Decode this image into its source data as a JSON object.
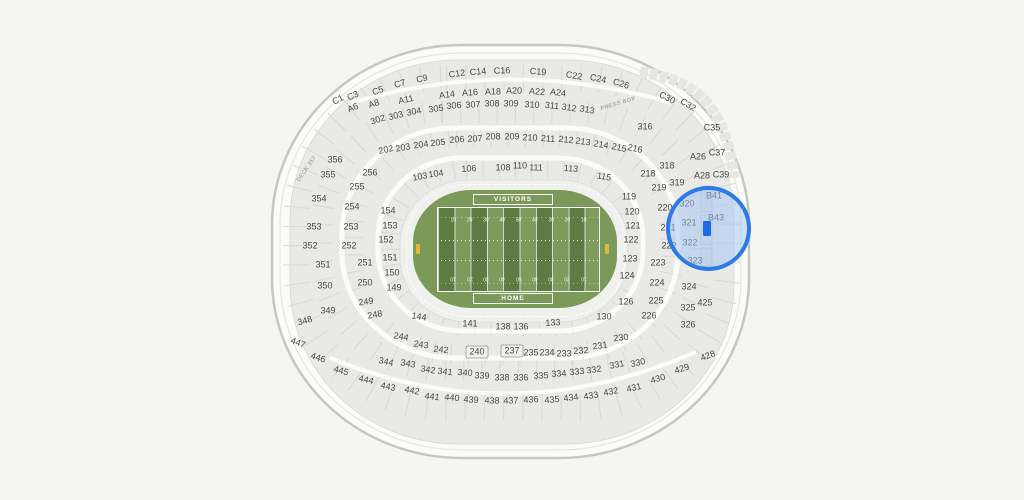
{
  "canvas": {
    "width": 1024,
    "height": 500,
    "background": "#f5f5f2"
  },
  "stadium": {
    "press_box_label": "PRESS BOX",
    "deck_label": "DECK 357",
    "wall_fill": "#fbfbf9",
    "wall_stroke": "#c6c6c3",
    "bowl_fill": "#e9e9e7"
  },
  "field": {
    "visitors_label": "VISITORS",
    "home_label": "HOME",
    "yard_numbers": [
      "10",
      "20",
      "30",
      "40",
      "50",
      "40",
      "30",
      "20",
      "10"
    ],
    "grass_outer": "#7b9a5a",
    "stripe_dark": "#5d7c44",
    "stripe_light": "#7e9b5e",
    "goalpost_color": "#ddb93c"
  },
  "highlight": {
    "circle_border": "#2e79e8",
    "circle_fill": "rgba(160,198,244,0.5)",
    "marker_color": "#1b69e5",
    "sections_in_view": [
      "320",
      "321",
      "322",
      "323",
      "B41",
      "B43"
    ]
  },
  "sections": [
    {
      "id": "C1",
      "x": 338,
      "y": 100,
      "r": -28
    },
    {
      "id": "C3",
      "x": 353,
      "y": 96,
      "r": -24
    },
    {
      "id": "C5",
      "x": 378,
      "y": 91,
      "r": -20
    },
    {
      "id": "C7",
      "x": 400,
      "y": 84,
      "r": -16
    },
    {
      "id": "C9",
      "x": 422,
      "y": 79,
      "r": -13
    },
    {
      "id": "C12",
      "x": 457,
      "y": 74,
      "r": -8
    },
    {
      "id": "C14",
      "x": 478,
      "y": 72,
      "r": -5
    },
    {
      "id": "C16",
      "x": 502,
      "y": 71,
      "r": -2
    },
    {
      "id": "C19",
      "x": 538,
      "y": 72,
      "r": 4
    },
    {
      "id": "C22",
      "x": 574,
      "y": 76,
      "r": 9
    },
    {
      "id": "C24",
      "x": 598,
      "y": 79,
      "r": 13
    },
    {
      "id": "C26",
      "x": 621,
      "y": 84,
      "r": 17
    },
    {
      "id": "C30",
      "x": 667,
      "y": 98,
      "r": 28
    },
    {
      "id": "C32",
      "x": 688,
      "y": 105,
      "r": 32
    },
    {
      "id": "C35",
      "x": 712,
      "y": 128,
      "r": 0
    },
    {
      "id": "C37",
      "x": 717,
      "y": 153,
      "r": 0
    },
    {
      "id": "C39",
      "x": 721,
      "y": 175,
      "r": 0
    },
    {
      "id": "A6",
      "x": 353,
      "y": 108,
      "r": -22
    },
    {
      "id": "A8",
      "x": 374,
      "y": 104,
      "r": -18
    },
    {
      "id": "A11",
      "x": 406,
      "y": 100,
      "r": -12
    },
    {
      "id": "A14",
      "x": 447,
      "y": 95,
      "r": -7
    },
    {
      "id": "A16",
      "x": 470,
      "y": 93,
      "r": -4
    },
    {
      "id": "A18",
      "x": 493,
      "y": 92,
      "r": -1
    },
    {
      "id": "A20",
      "x": 514,
      "y": 91,
      "r": 1
    },
    {
      "id": "A22",
      "x": 537,
      "y": 92,
      "r": 4
    },
    {
      "id": "A24",
      "x": 558,
      "y": 93,
      "r": 7
    },
    {
      "id": "A26",
      "x": 698,
      "y": 157,
      "r": 0
    },
    {
      "id": "A28",
      "x": 702,
      "y": 176,
      "r": 0
    },
    {
      "id": "302",
      "x": 378,
      "y": 120,
      "r": -18
    },
    {
      "id": "303",
      "x": 396,
      "y": 116,
      "r": -14
    },
    {
      "id": "304",
      "x": 414,
      "y": 112,
      "r": -11
    },
    {
      "id": "305",
      "x": 436,
      "y": 109,
      "r": -8
    },
    {
      "id": "306",
      "x": 454,
      "y": 106,
      "r": -5
    },
    {
      "id": "307",
      "x": 473,
      "y": 105,
      "r": -3
    },
    {
      "id": "308",
      "x": 492,
      "y": 104,
      "r": 0
    },
    {
      "id": "309",
      "x": 511,
      "y": 104,
      "r": 0
    },
    {
      "id": "310",
      "x": 532,
      "y": 105,
      "r": 3
    },
    {
      "id": "311",
      "x": 552,
      "y": 106,
      "r": 6
    },
    {
      "id": "312",
      "x": 569,
      "y": 108,
      "r": 8
    },
    {
      "id": "313",
      "x": 587,
      "y": 110,
      "r": 10
    },
    {
      "id": "316",
      "x": 645,
      "y": 127,
      "r": 0
    },
    {
      "id": "202",
      "x": 386,
      "y": 150,
      "r": -12
    },
    {
      "id": "203",
      "x": 403,
      "y": 148,
      "r": -10
    },
    {
      "id": "204",
      "x": 421,
      "y": 145,
      "r": -8
    },
    {
      "id": "205",
      "x": 438,
      "y": 143,
      "r": -6
    },
    {
      "id": "206",
      "x": 457,
      "y": 140,
      "r": -4
    },
    {
      "id": "207",
      "x": 475,
      "y": 139,
      "r": -2
    },
    {
      "id": "208",
      "x": 493,
      "y": 137,
      "r": 0
    },
    {
      "id": "209",
      "x": 512,
      "y": 137,
      "r": 0
    },
    {
      "id": "210",
      "x": 530,
      "y": 138,
      "r": 2
    },
    {
      "id": "211",
      "x": 548,
      "y": 139,
      "r": 4
    },
    {
      "id": "212",
      "x": 566,
      "y": 140,
      "r": 6
    },
    {
      "id": "213",
      "x": 583,
      "y": 142,
      "r": 8
    },
    {
      "id": "214",
      "x": 601,
      "y": 145,
      "r": 10
    },
    {
      "id": "215",
      "x": 619,
      "y": 148,
      "r": 12
    },
    {
      "id": "216",
      "x": 635,
      "y": 149,
      "r": 12
    },
    {
      "id": "103",
      "x": 420,
      "y": 177,
      "r": -10
    },
    {
      "id": "104",
      "x": 436,
      "y": 174,
      "r": -8
    },
    {
      "id": "106",
      "x": 469,
      "y": 169,
      "r": -4
    },
    {
      "id": "108",
      "x": 503,
      "y": 168,
      "r": 0
    },
    {
      "id": "110",
      "x": 520,
      "y": 166,
      "r": 0
    },
    {
      "id": "111",
      "x": 536,
      "y": 168,
      "r": 2
    },
    {
      "id": "113",
      "x": 571,
      "y": 169,
      "r": 5
    },
    {
      "id": "115",
      "x": 604,
      "y": 177,
      "r": 10
    },
    {
      "id": "356",
      "x": 335,
      "y": 160,
      "r": 0
    },
    {
      "id": "355",
      "x": 328,
      "y": 175,
      "r": 0
    },
    {
      "id": "354",
      "x": 319,
      "y": 199,
      "r": 0
    },
    {
      "id": "353",
      "x": 314,
      "y": 227,
      "r": 0
    },
    {
      "id": "352",
      "x": 310,
      "y": 246,
      "r": 0
    },
    {
      "id": "351",
      "x": 323,
      "y": 265,
      "r": 0
    },
    {
      "id": "350",
      "x": 325,
      "y": 286,
      "r": 0
    },
    {
      "id": "349",
      "x": 328,
      "y": 311,
      "r": 0
    },
    {
      "id": "348",
      "x": 305,
      "y": 321,
      "r": -15
    },
    {
      "id": "256",
      "x": 370,
      "y": 173,
      "r": 0
    },
    {
      "id": "255",
      "x": 357,
      "y": 187,
      "r": 0
    },
    {
      "id": "254",
      "x": 352,
      "y": 207,
      "r": 0
    },
    {
      "id": "253",
      "x": 351,
      "y": 227,
      "r": 0
    },
    {
      "id": "252",
      "x": 349,
      "y": 246,
      "r": 0
    },
    {
      "id": "251",
      "x": 365,
      "y": 263,
      "r": 0
    },
    {
      "id": "250",
      "x": 365,
      "y": 283,
      "r": 0
    },
    {
      "id": "249",
      "x": 366,
      "y": 302,
      "r": -8
    },
    {
      "id": "248",
      "x": 375,
      "y": 315,
      "r": -10
    },
    {
      "id": "154",
      "x": 388,
      "y": 211,
      "r": 0
    },
    {
      "id": "153",
      "x": 390,
      "y": 226,
      "r": 0
    },
    {
      "id": "152",
      "x": 386,
      "y": 240,
      "r": 0
    },
    {
      "id": "151",
      "x": 390,
      "y": 258,
      "r": 0
    },
    {
      "id": "150",
      "x": 392,
      "y": 273,
      "r": 0
    },
    {
      "id": "149",
      "x": 394,
      "y": 288,
      "r": 0
    },
    {
      "id": "119",
      "x": 629,
      "y": 197,
      "r": 0
    },
    {
      "id": "120",
      "x": 632,
      "y": 212,
      "r": 0
    },
    {
      "id": "121",
      "x": 633,
      "y": 226,
      "r": 0
    },
    {
      "id": "122",
      "x": 631,
      "y": 240,
      "r": 0
    },
    {
      "id": "123",
      "x": 630,
      "y": 259,
      "r": 0
    },
    {
      "id": "124",
      "x": 627,
      "y": 276,
      "r": 0
    },
    {
      "id": "126",
      "x": 626,
      "y": 302,
      "r": 0
    },
    {
      "id": "130",
      "x": 604,
      "y": 317,
      "r": 0
    },
    {
      "id": "218",
      "x": 648,
      "y": 174,
      "r": 0
    },
    {
      "id": "219",
      "x": 659,
      "y": 188,
      "r": 0
    },
    {
      "id": "220",
      "x": 665,
      "y": 208,
      "r": 0
    },
    {
      "id": "221",
      "x": 668,
      "y": 228,
      "r": 0
    },
    {
      "id": "222",
      "x": 669,
      "y": 246,
      "r": 0
    },
    {
      "id": "223",
      "x": 658,
      "y": 263,
      "r": 0
    },
    {
      "id": "224",
      "x": 657,
      "y": 283,
      "r": 0
    },
    {
      "id": "225",
      "x": 656,
      "y": 301,
      "r": 0
    },
    {
      "id": "226",
      "x": 649,
      "y": 316,
      "r": 0
    },
    {
      "id": "230",
      "x": 621,
      "y": 338,
      "r": -6
    },
    {
      "id": "318",
      "x": 667,
      "y": 166,
      "r": 0
    },
    {
      "id": "319",
      "x": 677,
      "y": 183,
      "r": 0
    },
    {
      "id": "320",
      "x": 687,
      "y": 204,
      "r": 0
    },
    {
      "id": "321",
      "x": 689,
      "y": 223,
      "r": 0
    },
    {
      "id": "322",
      "x": 690,
      "y": 243,
      "r": 0
    },
    {
      "id": "323",
      "x": 695,
      "y": 261,
      "r": 0
    },
    {
      "id": "324",
      "x": 689,
      "y": 287,
      "r": 0
    },
    {
      "id": "325",
      "x": 688,
      "y": 308,
      "r": 0
    },
    {
      "id": "326",
      "x": 688,
      "y": 325,
      "r": 0
    },
    {
      "id": "B41",
      "x": 714,
      "y": 196,
      "r": 0
    },
    {
      "id": "B43",
      "x": 716,
      "y": 218,
      "r": 0
    },
    {
      "id": "425",
      "x": 705,
      "y": 303,
      "r": 0
    },
    {
      "id": "144",
      "x": 419,
      "y": 317,
      "r": 8
    },
    {
      "id": "141",
      "x": 470,
      "y": 324,
      "r": 0
    },
    {
      "id": "138",
      "x": 503,
      "y": 327,
      "r": 0
    },
    {
      "id": "136",
      "x": 521,
      "y": 327,
      "r": 0
    },
    {
      "id": "133",
      "x": 553,
      "y": 323,
      "r": -4
    },
    {
      "id": "244",
      "x": 401,
      "y": 337,
      "r": 10
    },
    {
      "id": "243",
      "x": 421,
      "y": 345,
      "r": 8
    },
    {
      "id": "242",
      "x": 441,
      "y": 350,
      "r": 6
    },
    {
      "id": "240",
      "x": 477,
      "y": 352,
      "r": 0,
      "boxed": true
    },
    {
      "id": "237",
      "x": 512,
      "y": 351,
      "r": 0,
      "boxed": true
    },
    {
      "id": "235",
      "x": 531,
      "y": 353,
      "r": 0
    },
    {
      "id": "234",
      "x": 547,
      "y": 353,
      "r": 0
    },
    {
      "id": "233",
      "x": 564,
      "y": 354,
      "r": 0
    },
    {
      "id": "232",
      "x": 581,
      "y": 351,
      "r": -4
    },
    {
      "id": "231",
      "x": 600,
      "y": 346,
      "r": -8
    },
    {
      "id": "344",
      "x": 386,
      "y": 362,
      "r": 12
    },
    {
      "id": "343",
      "x": 408,
      "y": 364,
      "r": 10
    },
    {
      "id": "342",
      "x": 428,
      "y": 370,
      "r": 8
    },
    {
      "id": "341",
      "x": 445,
      "y": 372,
      "r": 6
    },
    {
      "id": "340",
      "x": 465,
      "y": 373,
      "r": 4
    },
    {
      "id": "339",
      "x": 482,
      "y": 376,
      "r": 2
    },
    {
      "id": "338",
      "x": 502,
      "y": 378,
      "r": 0
    },
    {
      "id": "336",
      "x": 521,
      "y": 378,
      "r": 0
    },
    {
      "id": "335",
      "x": 541,
      "y": 376,
      "r": -2
    },
    {
      "id": "334",
      "x": 559,
      "y": 374,
      "r": -4
    },
    {
      "id": "333",
      "x": 577,
      "y": 372,
      "r": -6
    },
    {
      "id": "332",
      "x": 594,
      "y": 370,
      "r": -8
    },
    {
      "id": "331",
      "x": 617,
      "y": 365,
      "r": -11
    },
    {
      "id": "330",
      "x": 638,
      "y": 363,
      "r": -13
    },
    {
      "id": "447",
      "x": 298,
      "y": 343,
      "r": 20
    },
    {
      "id": "446",
      "x": 318,
      "y": 358,
      "r": 18
    },
    {
      "id": "445",
      "x": 341,
      "y": 371,
      "r": 16
    },
    {
      "id": "444",
      "x": 366,
      "y": 380,
      "r": 14
    },
    {
      "id": "443",
      "x": 388,
      "y": 387,
      "r": 12
    },
    {
      "id": "442",
      "x": 412,
      "y": 391,
      "r": 10
    },
    {
      "id": "441",
      "x": 432,
      "y": 397,
      "r": 7
    },
    {
      "id": "440",
      "x": 452,
      "y": 398,
      "r": 5
    },
    {
      "id": "439",
      "x": 471,
      "y": 400,
      "r": 3
    },
    {
      "id": "438",
      "x": 492,
      "y": 401,
      "r": 1
    },
    {
      "id": "437",
      "x": 511,
      "y": 401,
      "r": -1
    },
    {
      "id": "436",
      "x": 531,
      "y": 400,
      "r": -3
    },
    {
      "id": "435",
      "x": 552,
      "y": 400,
      "r": -5
    },
    {
      "id": "434",
      "x": 571,
      "y": 398,
      "r": -7
    },
    {
      "id": "433",
      "x": 591,
      "y": 396,
      "r": -9
    },
    {
      "id": "432",
      "x": 611,
      "y": 392,
      "r": -11
    },
    {
      "id": "431",
      "x": 634,
      "y": 388,
      "r": -13
    },
    {
      "id": "430",
      "x": 658,
      "y": 379,
      "r": -16
    },
    {
      "id": "429",
      "x": 682,
      "y": 369,
      "r": -18
    },
    {
      "id": "428",
      "x": 708,
      "y": 356,
      "r": -21
    }
  ]
}
